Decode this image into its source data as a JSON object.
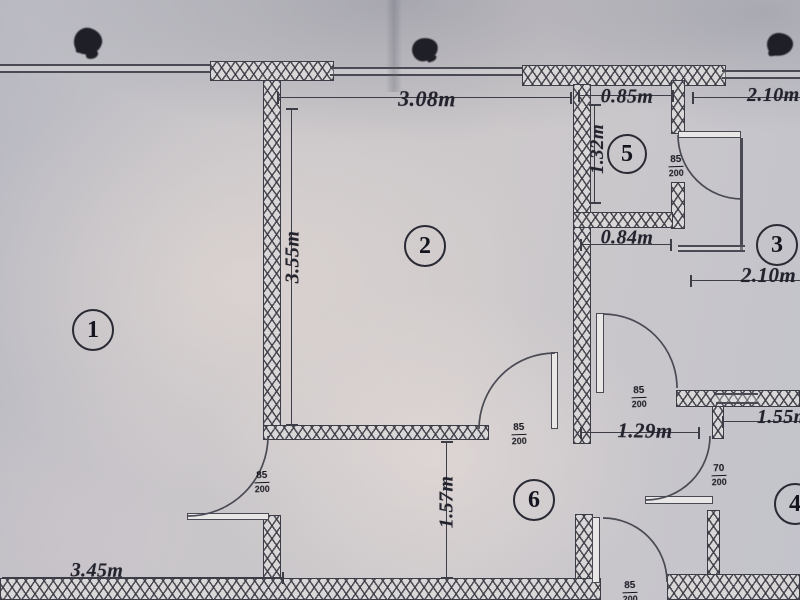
{
  "plan_title": "apartment floor plan photo",
  "rooms": {
    "r1": "1",
    "r2": "2",
    "r3": "3",
    "r4": "4",
    "r5": "5",
    "r6": "6"
  },
  "dims": {
    "top_room2": "3.08m",
    "top_room5": "0.85m",
    "top_room3": "2.10m",
    "room5_left": "1.32m",
    "below_room5": "0.84m",
    "room3_right": "2.10m",
    "room2_left": "3.55m",
    "hall_width": "1.29m",
    "room4_top": "1.55m",
    "hall_height": "1.57m",
    "room1_bottom": "3.45m"
  },
  "door_marks": {
    "room5": {
      "w": "85",
      "h": "200"
    },
    "hall_to_room3": {
      "w": "85",
      "h": "200"
    },
    "room2_to_hall": {
      "w": "85",
      "h": "200"
    },
    "room4": {
      "w": "70",
      "h": "200"
    },
    "room1": {
      "w": "85",
      "h": "200"
    },
    "bottom_exit": {
      "w": "85",
      "h": "200"
    }
  },
  "line_color": "#3d3d47",
  "paper_color": "#c7c5c9"
}
